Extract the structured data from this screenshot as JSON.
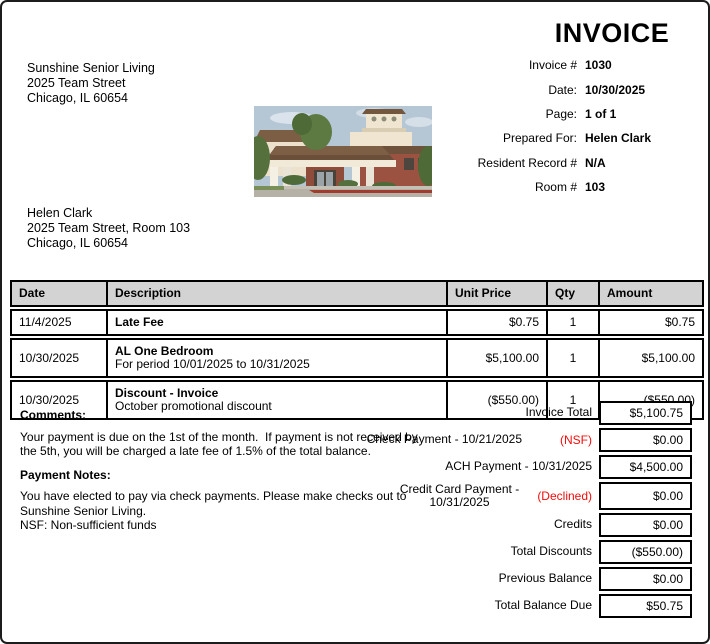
{
  "header": {
    "title": "INVOICE",
    "company": {
      "name": "Sunshine Senior Living",
      "street": "2025 Team Street",
      "city": "Chicago, IL 60654"
    }
  },
  "meta": {
    "fields": [
      {
        "label": "Invoice #",
        "value": "1030"
      },
      {
        "label": "Date:",
        "value": "10/30/2025"
      },
      {
        "label": "Page:",
        "value": "1 of 1"
      },
      {
        "label": "Prepared For:",
        "value": "Helen Clark"
      },
      {
        "label": "Resident Record #",
        "value": "N/A"
      },
      {
        "label": "Room #",
        "value": "103"
      }
    ]
  },
  "recipient": {
    "name": "Helen Clark",
    "street": "2025 Team Street, Room 103",
    "city": "Chicago, IL 60654"
  },
  "items_table": {
    "headers": [
      "Date",
      "Description",
      "Unit Price",
      "Qty",
      "Amount"
    ],
    "rows": [
      {
        "date": "11/4/2025",
        "description_title": "Late Fee",
        "unit_price": "$0.75",
        "qty": "1",
        "amount": "$0.75"
      },
      {
        "date": "10/30/2025",
        "description_title": "AL One Bedroom",
        "description_detail": "For period 10/01/2025 to 10/31/2025",
        "unit_price": "$5,100.00",
        "qty": "1",
        "amount": "$5,100.00"
      },
      {
        "date": "10/30/2025",
        "description_title": "Discount - Invoice",
        "description_detail": "October promotional discount",
        "unit_price": "($550.00)",
        "qty": "1",
        "amount": "($550.00)"
      }
    ]
  },
  "notes": {
    "comments_heading": "Comments:",
    "comments_body": "Your payment is due on the 1st of the month.  If payment is not received by the 5th, you will be charged a late fee of 1.5% of the total balance.",
    "payment_notes_heading": "Payment Notes:",
    "payment_notes_body": "You have elected to pay via check payments. Please make checks out to Sunshine Senior Living.",
    "nsf_note": "NSF: Non-sufficient funds"
  },
  "totals": {
    "rows": [
      {
        "label": "Invoice Total",
        "status": "",
        "amount": "$5,100.75"
      },
      {
        "label": "Check Payment - 10/21/2025",
        "status": "(NSF)",
        "amount": "$0.00"
      },
      {
        "label": "ACH Payment - 10/31/2025",
        "status": "",
        "amount": "$4,500.00"
      },
      {
        "label": "Credit Card Payment -\n10/31/2025",
        "status": "(Declined)",
        "amount": "$0.00"
      },
      {
        "label": "Credits",
        "status": "",
        "amount": "$0.00"
      },
      {
        "label": "Total Discounts",
        "status": "",
        "amount": "($550.00)"
      },
      {
        "label": "Previous Balance",
        "status": "",
        "amount": "$0.00"
      },
      {
        "label": "Total Balance Due",
        "status": "",
        "amount": "$50.75"
      }
    ]
  },
  "colors": {
    "status_red": "#f40b0b",
    "table_header_bg": "#d3d3d3",
    "border_black": "#000000"
  }
}
